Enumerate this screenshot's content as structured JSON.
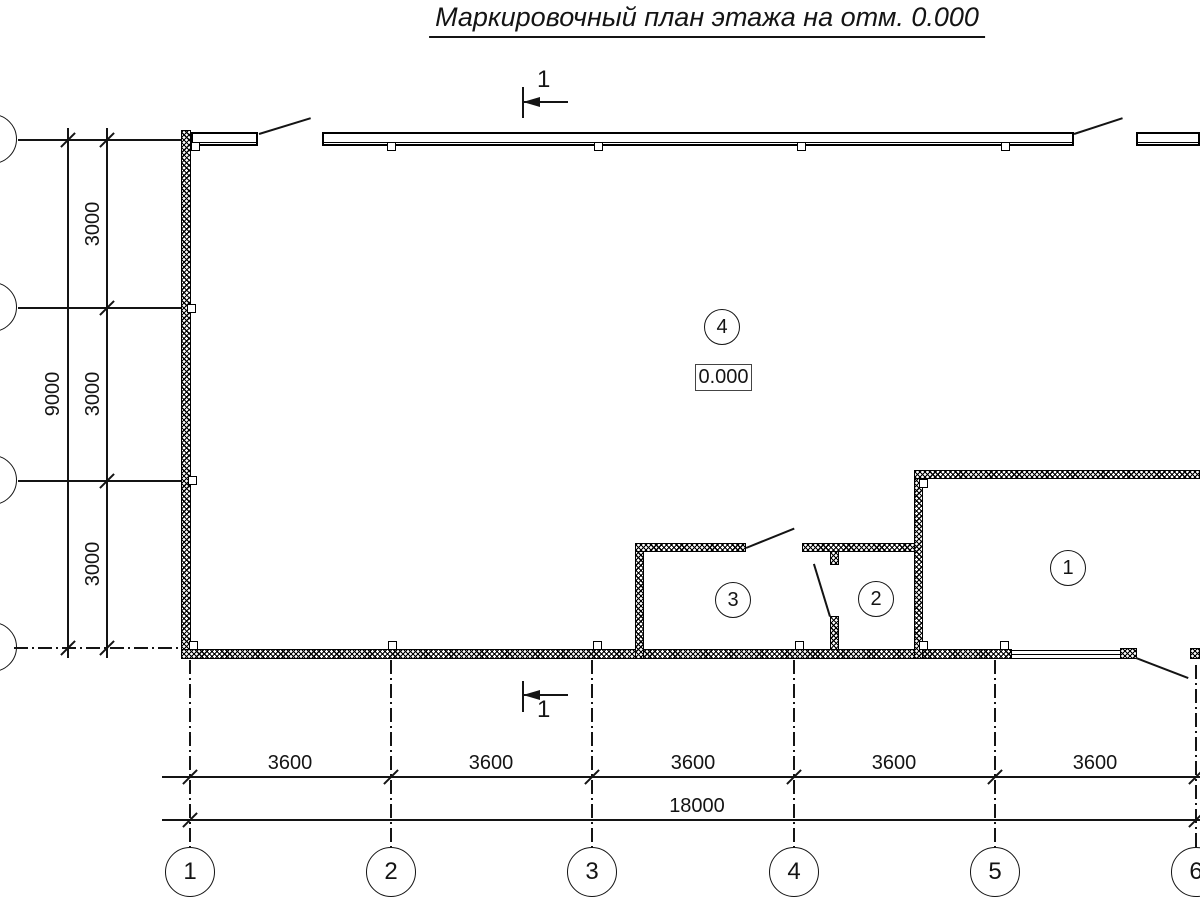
{
  "title": "Маркировочный план этажа на отм. 0.000",
  "section_mark": {
    "top": "1",
    "bottom": "1"
  },
  "elevation": "0.000",
  "rooms": {
    "r1": "1",
    "r2": "2",
    "r3": "3",
    "r4": "4"
  },
  "dims": {
    "left": {
      "overall": "9000",
      "segments": [
        "3000",
        "3000",
        "3000"
      ]
    },
    "bottom": {
      "overall": "18000",
      "segments": [
        "3600",
        "3600",
        "3600",
        "3600",
        "3600"
      ]
    }
  },
  "axes": {
    "columns": [
      "1",
      "2",
      "3",
      "4",
      "5",
      "6"
    ]
  }
}
